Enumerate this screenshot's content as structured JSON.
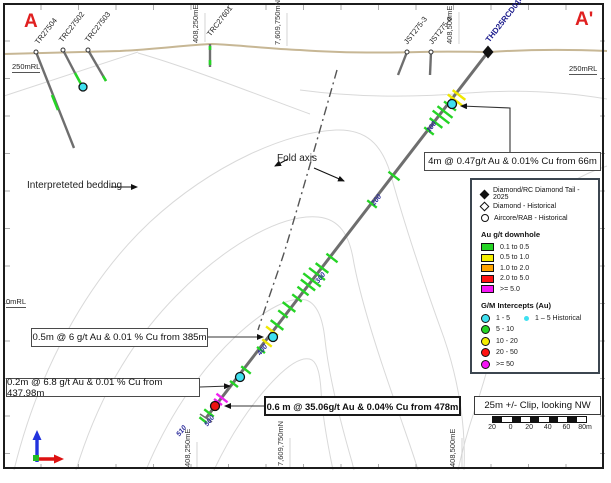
{
  "figure": {
    "corner_left": "A",
    "corner_right": "A'"
  },
  "elevation_labels": {
    "left_250": "250mRL",
    "right_250": "250mRL",
    "left_0": "0mRL"
  },
  "grid_labels": {
    "top": [
      "408,250mE",
      "7,609,750mN",
      "408,500mE"
    ],
    "bottom": [
      "408,250mE",
      "7,609,750mN",
      "408,500mE"
    ]
  },
  "drillholes": {
    "historical": [
      "TR27504",
      "TRC27502",
      "TRC27503",
      "TRC27601",
      "JST275-3",
      "JST275-4"
    ],
    "main": "THD25RCD014",
    "depth_marks": [
      "100",
      "200",
      "300",
      "400",
      "500",
      "510"
    ]
  },
  "annotations": {
    "fold_axis": "Fold axis",
    "bedding": "Interpreteted bedding",
    "intercept_66m": "4m @ 0.47g/t Au & 0.01% Cu from 66m",
    "intercept_385m": "0.5m @ 6 g/t Au & 0.01 % Cu from 385m",
    "intercept_437m": "0.2m @ 6.8 g/t Au & 0.01 % Cu from 437.98m",
    "intercept_478m": "0.6 m @ 35.06g/t Au & 0.04% Cu from 478m",
    "clip": "25m +/- Clip, looking NW"
  },
  "legend": {
    "symbols": [
      {
        "icon": "diamond-filled",
        "label": "Diamond/RC Diamond Tail - 2025"
      },
      {
        "icon": "diamond-open",
        "label": "Diamond - Historical"
      },
      {
        "icon": "circle-open",
        "label": "Aircore/RAB - Historical"
      }
    ],
    "au_header": "Au g/t downhole",
    "au_classes": [
      {
        "color": "#25d425",
        "label": "0.1 to 0.5"
      },
      {
        "color": "#f5ee00",
        "label": "0.5 to 1.0"
      },
      {
        "color": "#ffa500",
        "label": "1.0 to 2.0"
      },
      {
        "color": "#ff1212",
        "label": "2.0 to 5.0"
      },
      {
        "color": "#f515f5",
        "label": ">= 5.0"
      }
    ],
    "gm_header": "G/M Intercepts (Au)",
    "gm_classes": [
      {
        "color": "#3fe0f0",
        "label": "1 - 5"
      },
      {
        "color": "#25d425",
        "label": "5 - 10"
      },
      {
        "color": "#f5ee00",
        "label": "10 - 20"
      },
      {
        "color": "#ff1212",
        "label": "20 - 50"
      },
      {
        "color": "#f515f5",
        "label": ">= 50"
      }
    ],
    "gm_historical": {
      "color": "#3fe0f0",
      "label": "1 – 5 Historical"
    }
  },
  "scale_bar": {
    "ticks": [
      "20",
      "0",
      "20",
      "40",
      "60",
      "80m"
    ]
  },
  "intercepts": {
    "ticks": [
      {
        "x": 459,
        "y": 95,
        "c": "y",
        "l": 16
      },
      {
        "x": 455,
        "y": 100,
        "c": "y",
        "l": 18
      },
      {
        "x": 450,
        "y": 106,
        "c": "g",
        "l": 15
      },
      {
        "x": 445,
        "y": 112,
        "c": "g",
        "l": 19
      },
      {
        "x": 441,
        "y": 117,
        "c": "g",
        "l": 21
      },
      {
        "x": 436,
        "y": 123,
        "c": "g",
        "l": 16
      },
      {
        "x": 429,
        "y": 131,
        "c": "g",
        "l": 12
      },
      {
        "x": 394,
        "y": 176,
        "c": "g",
        "l": 14
      },
      {
        "x": 372,
        "y": 204,
        "c": "g",
        "l": 12
      },
      {
        "x": 332,
        "y": 258,
        "c": "g",
        "l": 14
      },
      {
        "x": 322,
        "y": 268,
        "c": "g",
        "l": 16
      },
      {
        "x": 317,
        "y": 274,
        "c": "g",
        "l": 20
      },
      {
        "x": 312,
        "y": 280,
        "c": "g",
        "l": 22
      },
      {
        "x": 308,
        "y": 285,
        "c": "g",
        "l": 18
      },
      {
        "x": 303,
        "y": 291,
        "c": "g",
        "l": 14
      },
      {
        "x": 297,
        "y": 298,
        "c": "g",
        "l": 12
      },
      {
        "x": 289,
        "y": 307,
        "c": "g",
        "l": 16
      },
      {
        "x": 283,
        "y": 314,
        "c": "g",
        "l": 12
      },
      {
        "x": 277,
        "y": 325,
        "c": "g",
        "l": 16
      },
      {
        "x": 272,
        "y": 331,
        "c": "y",
        "l": 15
      },
      {
        "x": 267,
        "y": 343,
        "c": "y",
        "l": 12
      },
      {
        "x": 261,
        "y": 350,
        "c": "g",
        "l": 10
      },
      {
        "x": 246,
        "y": 370,
        "c": "g",
        "l": 12
      },
      {
        "x": 234,
        "y": 384,
        "c": "g",
        "l": 10
      },
      {
        "x": 222,
        "y": 398,
        "c": "m",
        "l": 14
      },
      {
        "x": 218,
        "y": 402,
        "c": "m",
        "l": 10
      },
      {
        "x": 209,
        "y": 413,
        "c": "g",
        "l": 12
      },
      {
        "x": 203,
        "y": 420,
        "c": "g",
        "l": 9
      }
    ],
    "circles": [
      {
        "x": 452,
        "y": 104,
        "color": "#3fe0f0",
        "r": 4.5
      },
      {
        "x": 273,
        "y": 337,
        "color": "#3fe0f0",
        "r": 4.5
      },
      {
        "x": 240,
        "y": 377,
        "color": "#3fe0f0",
        "r": 4.5
      },
      {
        "x": 215,
        "y": 406,
        "color": "#ee1111",
        "r": 4.5
      },
      {
        "x": 83,
        "y": 87,
        "color": "#3fe0f0",
        "r": 4
      }
    ]
  },
  "colors": {
    "green": "#25d425",
    "yellow": "#f0e800",
    "magenta": "#f020f0",
    "surface": "#c7b795",
    "hole_gray": "#6e6e6e",
    "contour": "#d9d9d9"
  }
}
